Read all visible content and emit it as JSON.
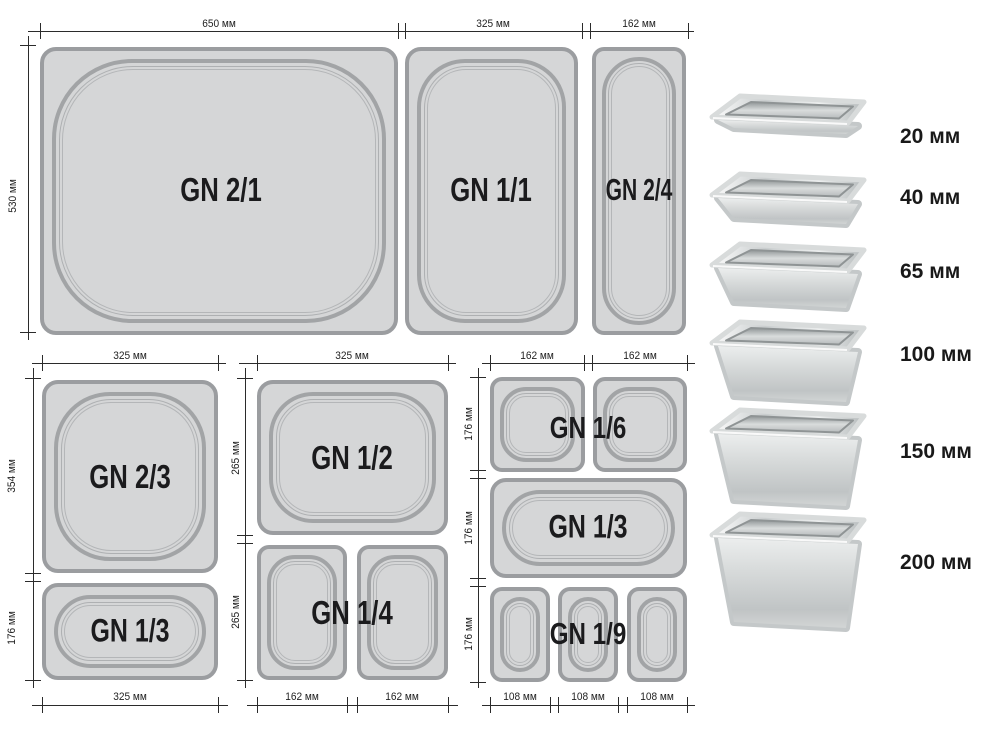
{
  "units": "мм",
  "top_row": {
    "dim_width_1": "650 мм",
    "dim_width_2": "325 мм",
    "dim_width_3": "162 мм",
    "dim_height": "530 мм",
    "pans": [
      {
        "label": "GN 2/1"
      },
      {
        "label": "GN 1/1"
      },
      {
        "label": "GN 2/4"
      }
    ]
  },
  "group_left": {
    "dim_width_top": "325 мм",
    "dim_height_1": "354 мм",
    "dim_height_2": "176 мм",
    "dim_width_bottom": "325 мм",
    "pans": [
      {
        "label": "GN 2/3"
      },
      {
        "label": "GN 1/3"
      }
    ]
  },
  "group_middle": {
    "dim_width_top": "325 мм",
    "dim_height_1": "265 мм",
    "dim_height_2": "265 мм",
    "dim_width_bottom_1": "162 мм",
    "dim_width_bottom_2": "162 мм",
    "pans": [
      {
        "label": "GN 1/2"
      },
      {
        "label": "GN 1/4"
      }
    ]
  },
  "group_right": {
    "dim_width_top_1": "162 мм",
    "dim_width_top_2": "162 мм",
    "dim_height_1": "176 мм",
    "dim_height_2": "176 мм",
    "dim_height_3": "176 мм",
    "dim_width_bottom_1": "108 мм",
    "dim_width_bottom_2": "108 мм",
    "dim_width_bottom_3": "108 мм",
    "pans": [
      {
        "label": "GN 1/6"
      },
      {
        "label": "GN 1/3"
      },
      {
        "label": "GN 1/9"
      }
    ]
  },
  "depth_column": {
    "items": [
      {
        "label": "20 мм"
      },
      {
        "label": "40 мм"
      },
      {
        "label": "65 мм"
      },
      {
        "label": "100 мм"
      },
      {
        "label": "150 мм"
      },
      {
        "label": "200 мм"
      }
    ]
  },
  "colors": {
    "background": "#ffffff",
    "pan_fill": "#d5d6d7",
    "pan_border": "#9b9da0",
    "dimension_line": "#2b2b2b",
    "label_text": "#1b1b1d"
  }
}
